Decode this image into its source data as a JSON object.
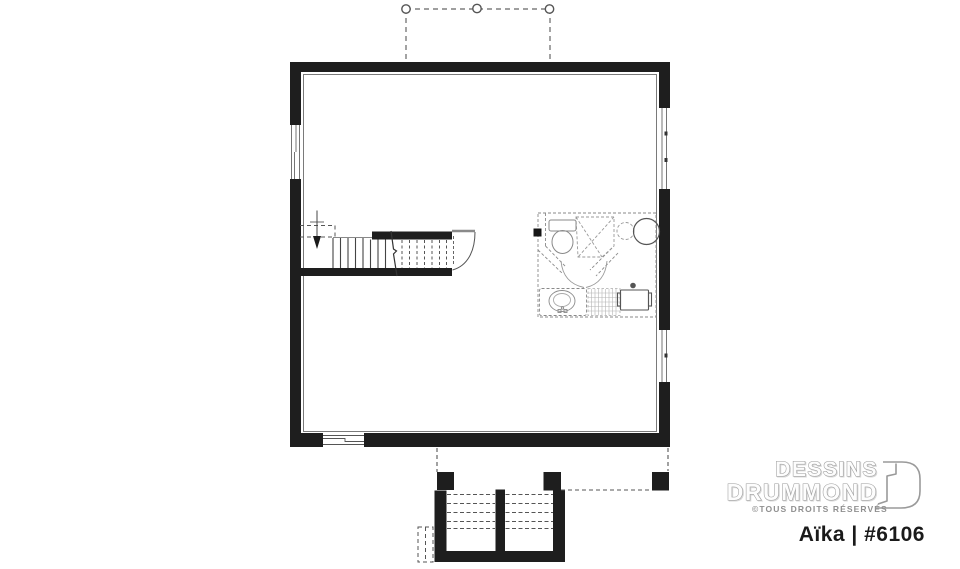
{
  "branding": {
    "name_line1": "DESSINS",
    "name_line2": "DRUMMOND",
    "copyright": "©TOUS DROITS RÉSERVÉS",
    "logomark_icon": "drummond-d-logomark",
    "plan_title": "Aïka | #6106"
  },
  "colors": {
    "background": "#ffffff",
    "wall": "#1e1e1e",
    "thin_line": "#777777",
    "dashed_line": "#666666",
    "fixture_line": "#8a8a8a",
    "logo_gray": "#9a9a9a",
    "title_text": "#1a1a1a"
  }
}
